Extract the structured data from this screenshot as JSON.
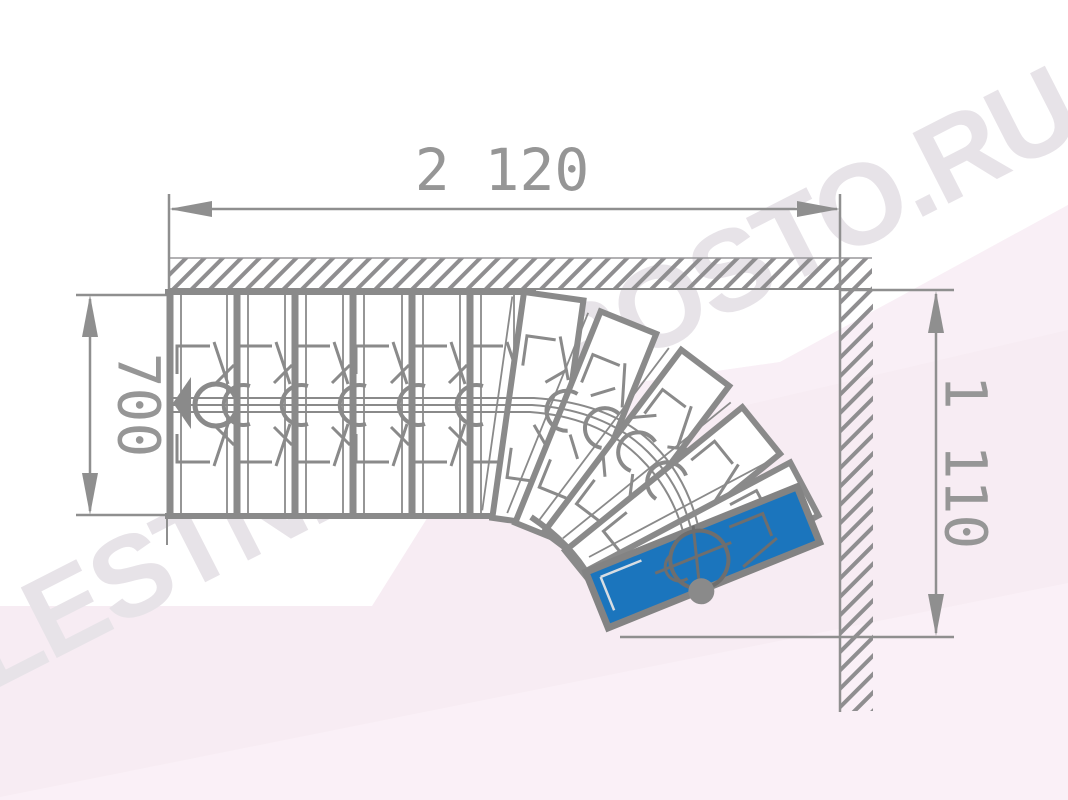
{
  "page": {
    "title": "Staircase floor plan - top view",
    "watermark": "LESTNICY-PROSTO.RU"
  },
  "dimensions": {
    "total_length": {
      "value": "2 120",
      "position": "top"
    },
    "flight_width": {
      "value": "700",
      "position": "left"
    },
    "turn_depth": {
      "value": "1 110",
      "position": "right"
    }
  },
  "stairs": {
    "straight_treads": 6,
    "winder_treads": 5,
    "highlighted_treads": 1,
    "turn": "90-degree turn along two hatched walls",
    "walk_line": "center walking line with start arrow and module circles"
  },
  "colors": {
    "highlight_blue": "#1b75bd",
    "line_gray": "#8a8a8a",
    "dim_text_gray": "#969696",
    "background_pink": "#f7ecf3",
    "watermark_gray": "#e7e3e8"
  }
}
